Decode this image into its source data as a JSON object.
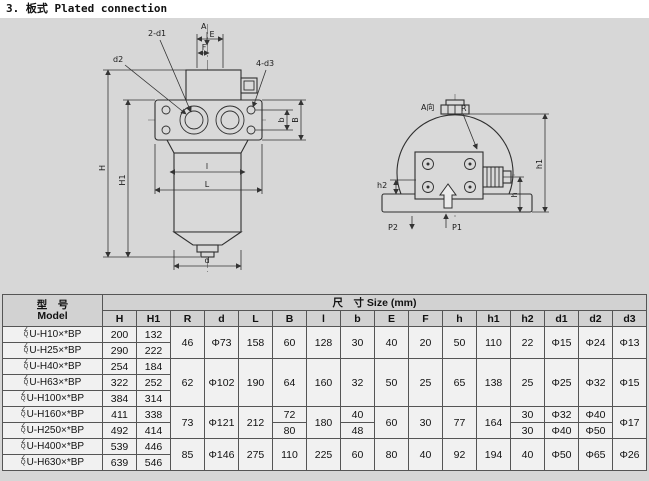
{
  "title": "3. 板式  Plated connection",
  "drawing": {
    "front": {
      "section_arrow": "A",
      "dim_E": "E",
      "dim_F": "F",
      "label_2d1": "2-d1",
      "label_d2": "d2",
      "label_4d3": "4-d3",
      "dim_H": "H",
      "dim_H1": "H1",
      "dim_b": "b",
      "dim_B": "B",
      "dim_l": "l",
      "dim_L": "L",
      "dim_d": "d"
    },
    "side": {
      "view_label": "A向",
      "label_R": "R",
      "dim_h": "h",
      "dim_h1": "h1",
      "dim_h2": "h2",
      "port_P1": "P1",
      "port_P2": "P2"
    }
  },
  "table": {
    "model_header_cn": "型　号",
    "model_header_en": "Model",
    "size_header": "尺　寸 Size (mm)",
    "prefix_top": "Z",
    "prefix_bottom": "Q",
    "columns": [
      "H",
      "H1",
      "R",
      "d",
      "L",
      "B",
      "l",
      "b",
      "E",
      "F",
      "h",
      "h1",
      "h2",
      "d1",
      "d2",
      "d3"
    ],
    "rows": {
      "r0": {
        "model": "U-H10×*BP",
        "H": "200",
        "H1": "132",
        "R": "46",
        "d": "Φ73",
        "L": "158",
        "B": "60",
        "l": "128",
        "b": "30",
        "E": "40",
        "F": "20",
        "h": "50",
        "h1": "110",
        "h2": "22",
        "d1": "Φ15",
        "d2": "Φ24",
        "d3": "Φ13"
      },
      "r1": {
        "model": "U-H25×*BP",
        "H": "290",
        "H1": "222"
      },
      "r2": {
        "model": "U-H40×*BP",
        "H": "254",
        "H1": "184",
        "R": "62",
        "d": "Φ102",
        "L": "190",
        "B": "64",
        "l": "160",
        "b": "32",
        "E": "50",
        "F": "25",
        "h": "65",
        "h1": "138",
        "h2": "25",
        "d1": "Φ25",
        "d2": "Φ32",
        "d3": "Φ15"
      },
      "r3": {
        "model": "U-H63×*BP",
        "H": "322",
        "H1": "252"
      },
      "r4": {
        "model": "U-H100×*BP",
        "H": "384",
        "H1": "314"
      },
      "r5": {
        "model": "U-H160×*BP",
        "H": "411",
        "H1": "338",
        "R": "73",
        "d": "Φ121",
        "L": "212",
        "B": "72",
        "l": "180",
        "b": "40",
        "E": "60",
        "F": "30",
        "h": "77",
        "h1": "164",
        "h2": "30",
        "d1": "Φ32",
        "d2": "Φ40",
        "d3": "Φ17"
      },
      "r6": {
        "model": "U-H250×*BP",
        "H": "492",
        "H1": "414",
        "B": "80",
        "b": "48",
        "h2": "30",
        "d1": "Φ40",
        "d2": "Φ50"
      },
      "r7": {
        "model": "U-H400×*BP",
        "H": "539",
        "H1": "446",
        "R": "85",
        "d": "Φ146",
        "L": "275",
        "B": "110",
        "l": "225",
        "b": "60",
        "E": "80",
        "F": "40",
        "h": "92",
        "h1": "194",
        "h2": "40",
        "d1": "Φ50",
        "d2": "Φ65",
        "d3": "Φ26"
      },
      "r8": {
        "model": "U-H630×*BP",
        "H": "639",
        "H1": "546"
      }
    }
  }
}
